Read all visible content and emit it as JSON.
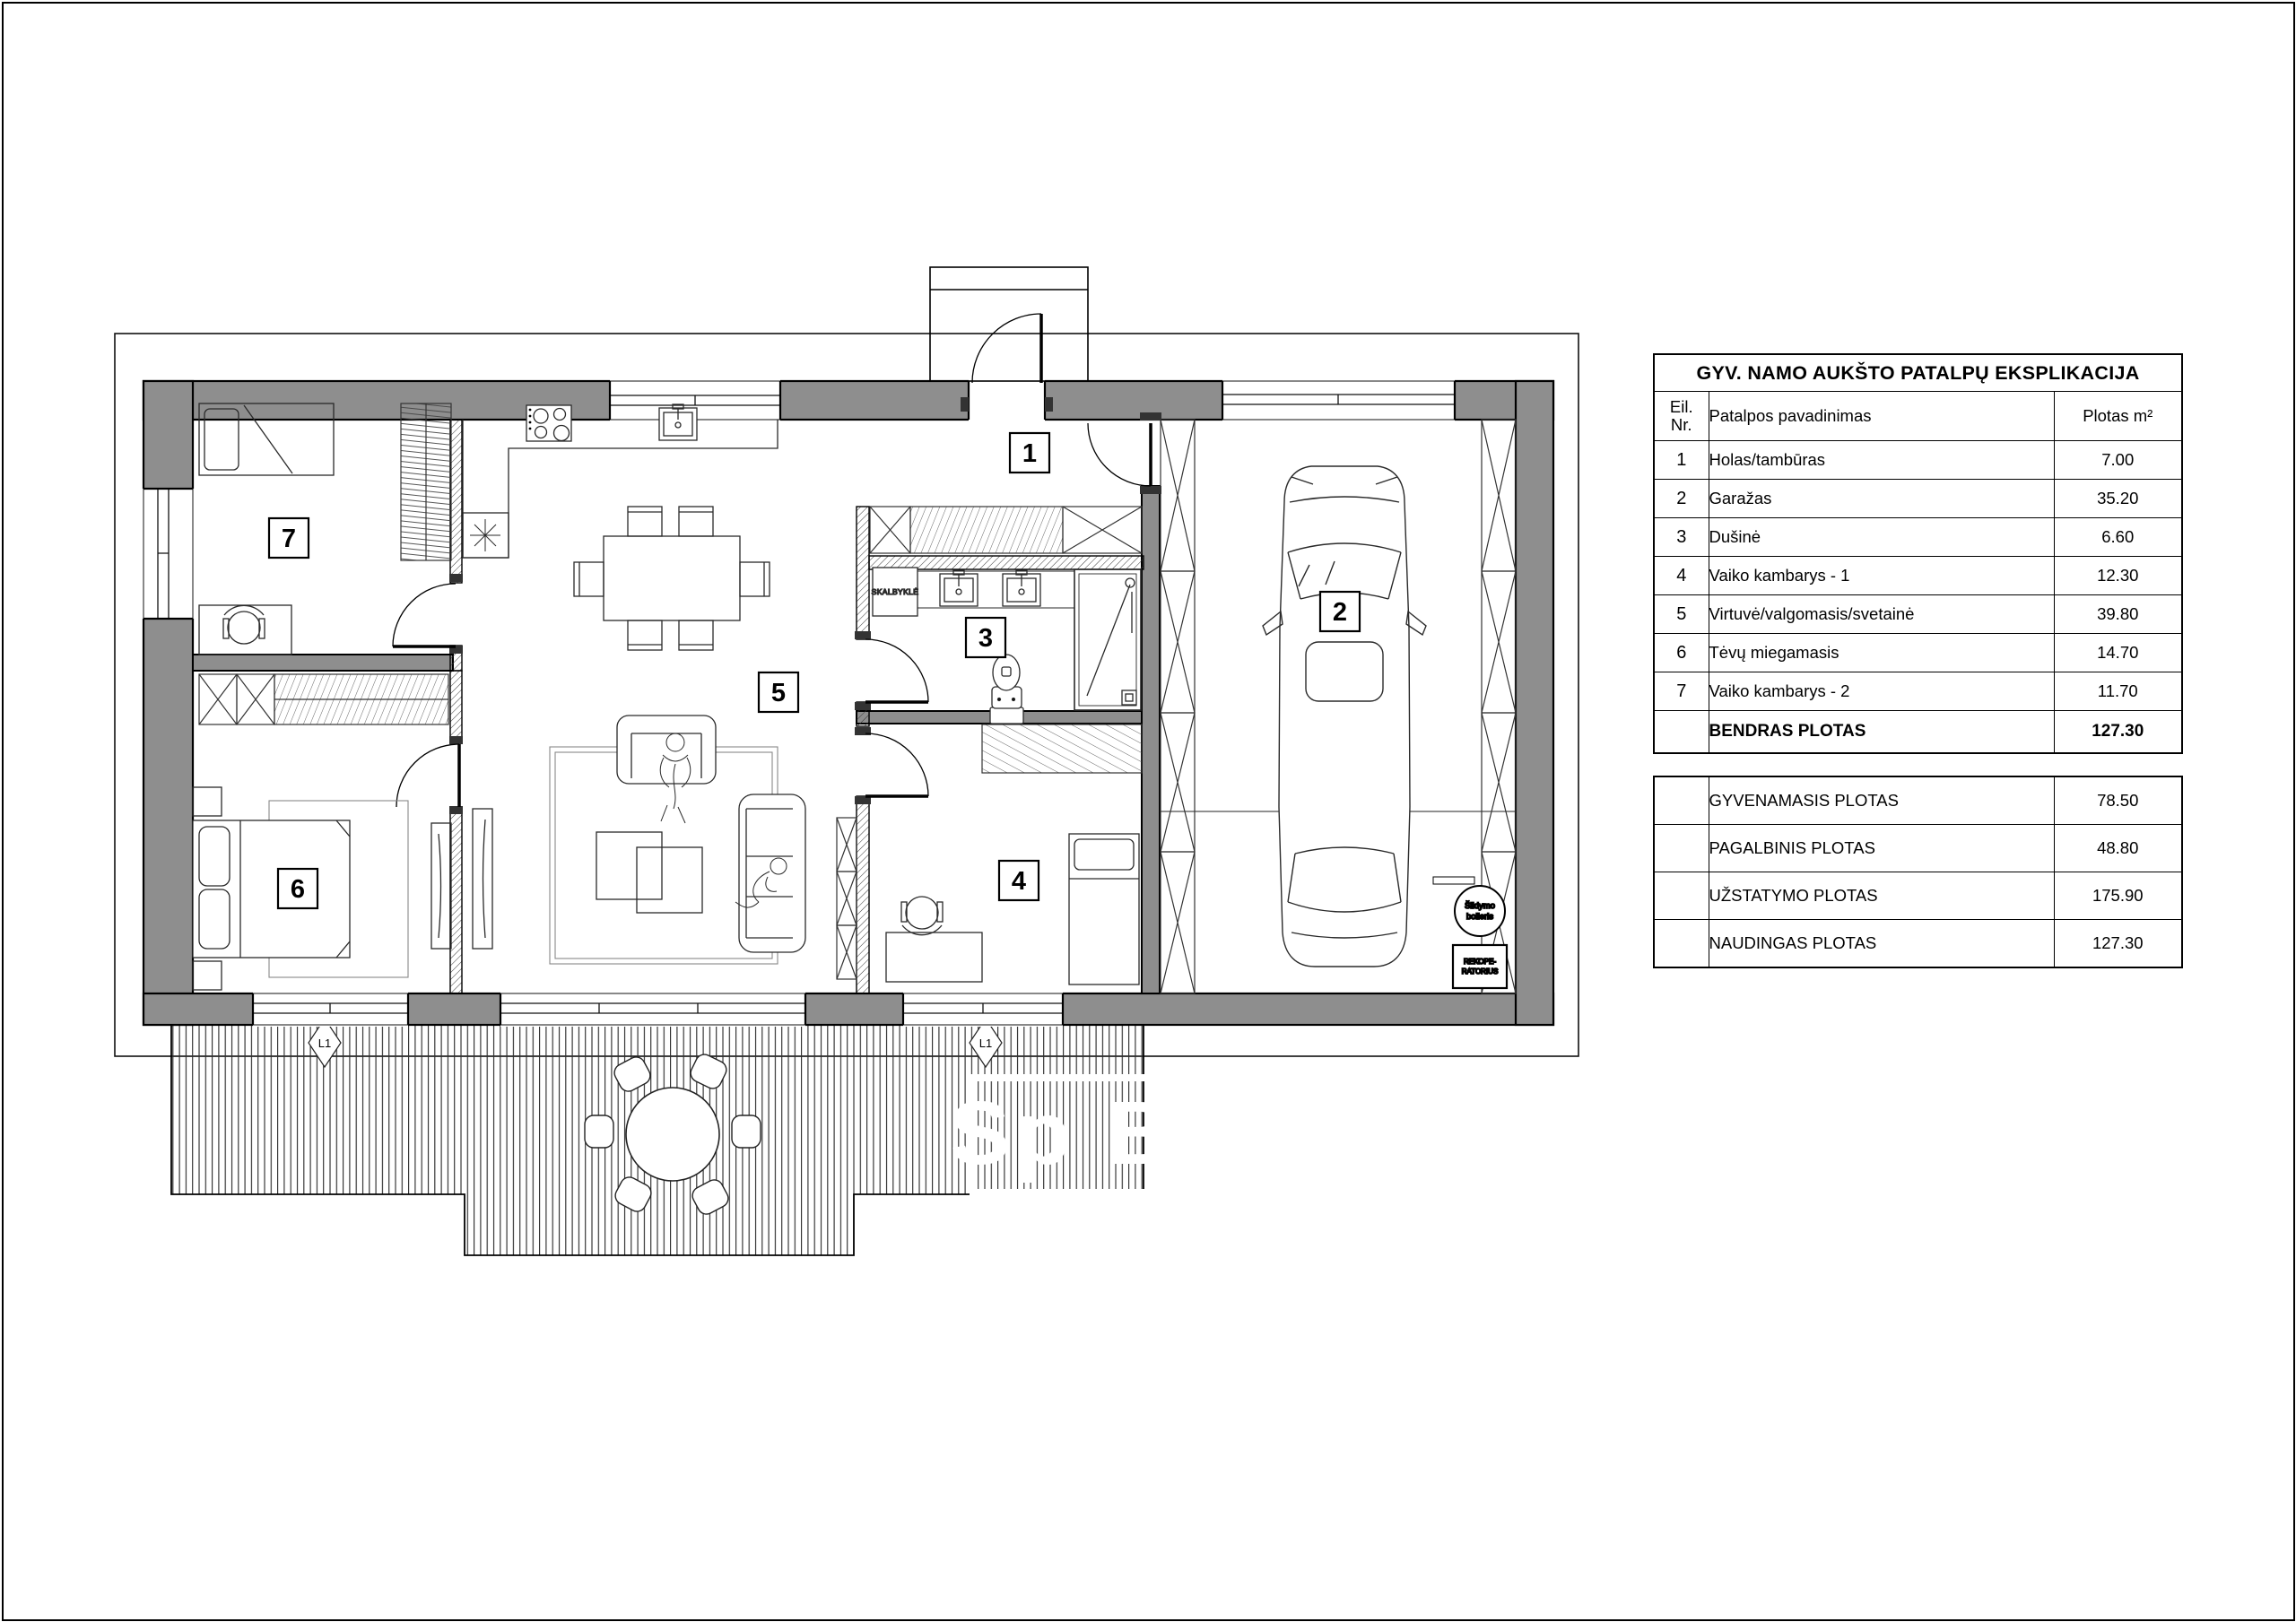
{
  "plan": {
    "room_labels": {
      "r1": "1",
      "r2": "2",
      "r3": "3",
      "r4": "4",
      "r5": "5",
      "r6": "6",
      "r7": "7"
    },
    "window_marker": "L1",
    "laundry_label": "SKALBYKLĖ",
    "boiler_line1": "Šildymo",
    "boiler_line2": "boileris",
    "recuperator_line1": "REKOPE-",
    "recuperator_line2": "RATORIUS",
    "watermark": "Sp B"
  },
  "legend": {
    "title": "GYV. NAMO AUKŠTO PATALPŲ EKSPLIKACIJA",
    "headers": {
      "nr_line1": "Eil.",
      "nr_line2": "Nr.",
      "name": "Patalpos pavadinimas",
      "area": "Plotas m²"
    },
    "rows": [
      {
        "nr": "1",
        "name": "Holas/tambūras",
        "area": "7.00"
      },
      {
        "nr": "2",
        "name": "Garažas",
        "area": "35.20"
      },
      {
        "nr": "3",
        "name": "Dušinė",
        "area": "6.60"
      },
      {
        "nr": "4",
        "name": "Vaiko kambarys - 1",
        "area": "12.30"
      },
      {
        "nr": "5",
        "name": "Virtuvė/valgomasis/svetainė",
        "area": "39.80"
      },
      {
        "nr": "6",
        "name": "Tėvų miegamasis",
        "area": "14.70"
      },
      {
        "nr": "7",
        "name": "Vaiko kambarys - 2",
        "area": "11.70"
      }
    ],
    "total": {
      "label": "BENDRAS PLOTAS",
      "area": "127.30"
    }
  },
  "summary": {
    "rows": [
      {
        "label": "GYVENAMASIS PLOTAS",
        "area": "78.50"
      },
      {
        "label": "PAGALBINIS PLOTAS",
        "area": "48.80"
      },
      {
        "label": "UŽSTATYMO PLOTAS",
        "area": "175.90"
      },
      {
        "label": "NAUDINGAS PLOTAS",
        "area": "127.30"
      }
    ]
  }
}
